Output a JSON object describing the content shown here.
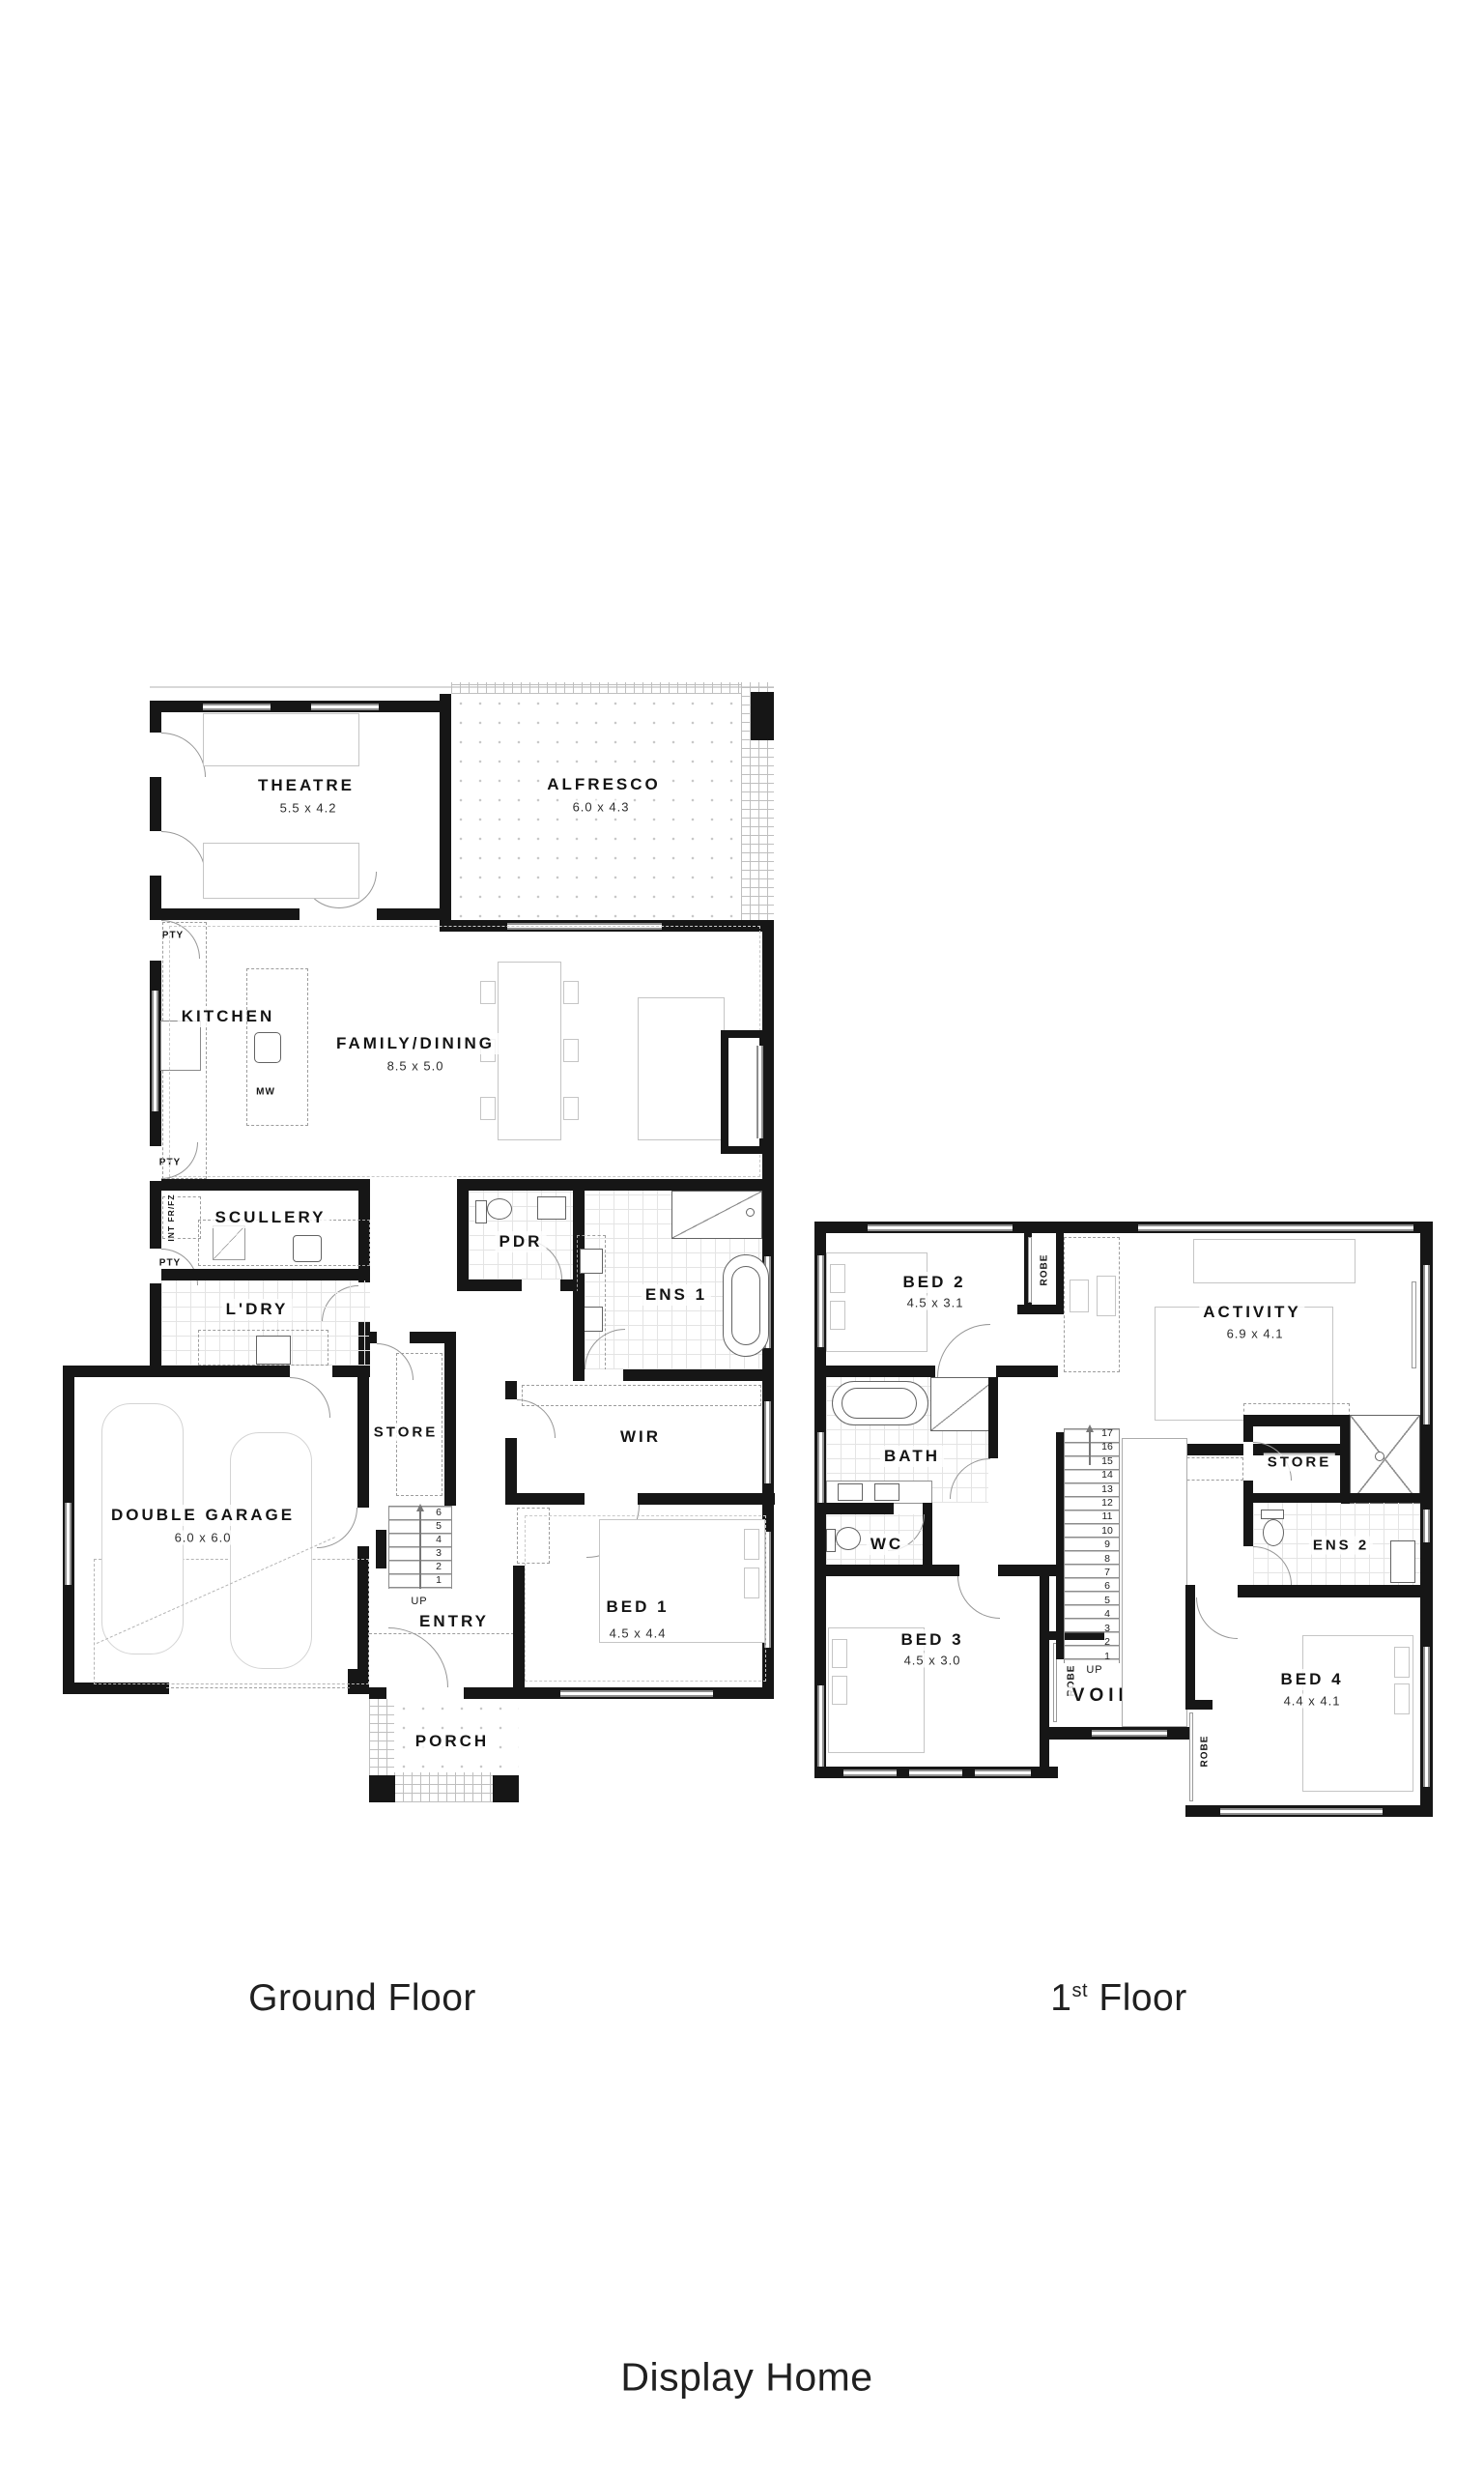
{
  "ground_floor": {
    "caption": "Ground Floor",
    "rooms": {
      "theatre": {
        "name": "THEATRE",
        "dims": "5.5 x 4.2"
      },
      "alfresco": {
        "name": "ALFRESCO",
        "dims": "6.0 x 4.3"
      },
      "kitchen": {
        "name": "KITCHEN"
      },
      "family_dining": {
        "name": "FAMILY/DINING",
        "dims": "8.5 x 5.0"
      },
      "scullery": {
        "name": "SCULLERY"
      },
      "laundry": {
        "name": "L'DRY"
      },
      "pdr": {
        "name": "PDR"
      },
      "ens1": {
        "name": "ENS 1"
      },
      "wir": {
        "name": "WIR"
      },
      "store": {
        "name": "STORE"
      },
      "entry": {
        "name": "ENTRY"
      },
      "bed1": {
        "name": "BED 1",
        "dims": "4.5 x 4.4"
      },
      "porch": {
        "name": "PORCH"
      },
      "garage": {
        "name": "DOUBLE GARAGE",
        "dims": "6.0 x 6.0"
      }
    },
    "labels": {
      "pty": "PTY",
      "int_fridge": "INT FR/FZ",
      "microwave": "MW",
      "up": "UP"
    },
    "stairs": [
      "6",
      "5",
      "4",
      "3",
      "2",
      "1"
    ]
  },
  "first_floor": {
    "caption_number": "1",
    "caption_suffix": "st",
    "caption_word": "Floor",
    "rooms": {
      "bed2": {
        "name": "BED 2",
        "dims": "4.5 x 3.1"
      },
      "activity": {
        "name": "ACTIVITY",
        "dims": "6.9 x 4.1"
      },
      "bath": {
        "name": "BATH"
      },
      "wc": {
        "name": "WC"
      },
      "bed3": {
        "name": "BED 3",
        "dims": "4.5 x 3.0"
      },
      "void": {
        "name": "VOID"
      },
      "store": {
        "name": "STORE"
      },
      "ens2": {
        "name": "ENS 2"
      },
      "bed4": {
        "name": "BED 4",
        "dims": "4.4 x 4.1"
      }
    },
    "labels": {
      "robe": "ROBE",
      "up": "UP"
    },
    "stairs": [
      "17",
      "16",
      "15",
      "14",
      "13",
      "12",
      "11",
      "10",
      "9",
      "8",
      "7",
      "6",
      "5",
      "4",
      "3",
      "2",
      "1"
    ]
  },
  "footer": {
    "title": "Display Home"
  },
  "colors": {
    "wall": "#161616",
    "furniture": "#c5c5c5",
    "fixture": "#636363",
    "text": "#141414"
  }
}
